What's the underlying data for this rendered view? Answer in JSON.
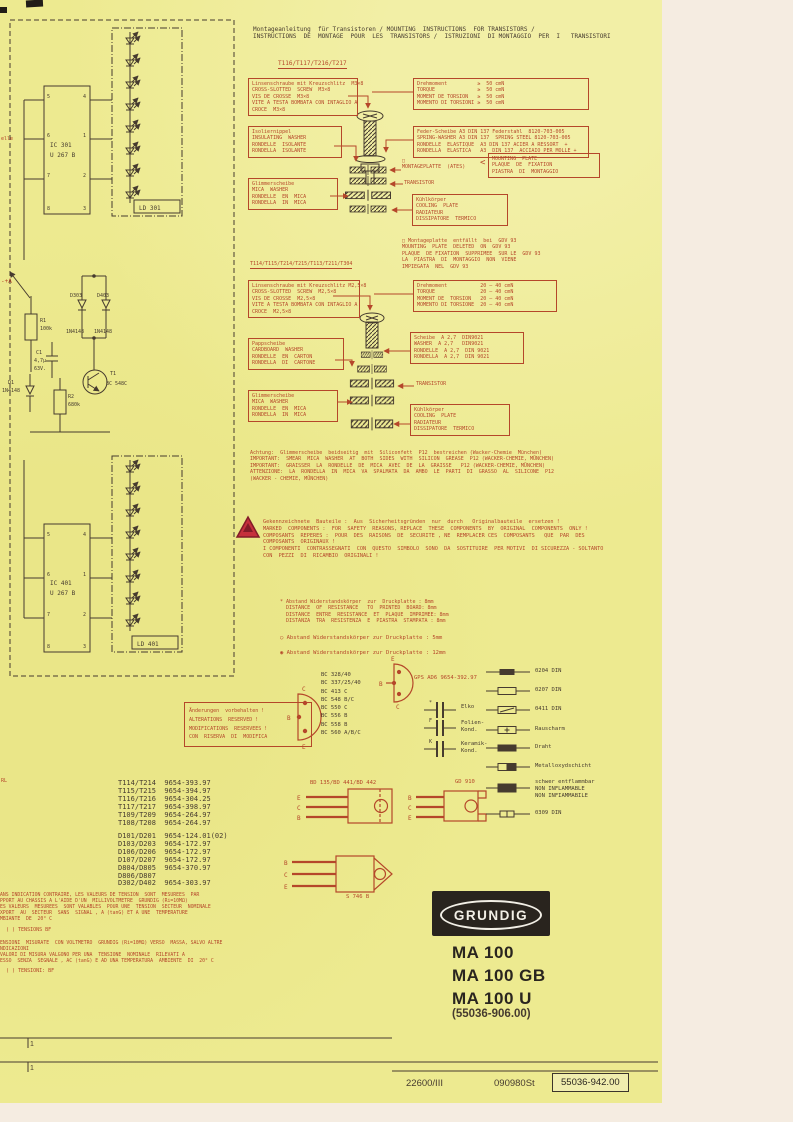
{
  "colors": {
    "accent": "#b5472a",
    "paper": "#edea90",
    "ink": "#463b2f"
  },
  "header": {
    "title": [
      "Montageanleitung  für Transistoren / MOUNTING  INSTRUCTIONS  FOR TRANSISTORS /",
      "INSTRUCTIONS  DE  MONTAGE  POUR  LES  TRANSISTORS /  ISTRUZIONI  DI MONTAGGIO  PER  I   TRANSISTORI"
    ]
  },
  "group1": {
    "heading": "T116/T117/T216/T217",
    "screw": [
      "Linsenschraube mit Kreuzschlitz  M3×8",
      "CROSS-SLOTTED  SCREW  M3×8",
      "VIS DE CROSSE  M3×8",
      "VITE A TESTA BOMBATA CON INTAGLIO A",
      "CROCE  M3×8"
    ],
    "torque": [
      "Drehmoment          ≥  50 cmN",
      "TORQUE              ≥  50 cmN",
      "MOMENT DE TORSION   ≥  50 cmN",
      "MOMENTO DI TORSIONI ≥  50 cmN"
    ],
    "spring": [
      "Feder-Scheibe A3 DIN 137 Federstahl  8120-703-005",
      "SPRING-WASHER A3 DIN 137  SPRING STEEL 8120-703-005",
      "RONDELLE  ELASTIQUE  A3 DIN 137 ACIER A RESSORT  +",
      "RONDELLA  ELASTICA   A3  DIN 137  ACCIAIO PER MOLLE +"
    ],
    "insulating": [
      "Isoliernippel",
      "INSULATING  WASHER",
      "RONDELLE  ISOLANTE",
      "RONDELLA  ISOLANTE"
    ],
    "mica": [
      "Glimmerscheibe",
      "MICA  WASHER",
      "RONDELLE  EN  MICA",
      "RONDELLA  IN  MICA"
    ],
    "plate_label": [
      "□",
      "MONTAGEPLATTE  (ATES)"
    ],
    "brace": "<",
    "plate_box": [
      "MOUNTING  PLATE",
      "PLAQUE  DE  FIXATION",
      "PIASTRA  DI  MONTAGGIO"
    ],
    "transistor_label": "TRANSISTOR",
    "cooling": [
      "Kühlkörper",
      "COOLING  PLATE",
      "RADIATEUR",
      "DISSIPATORE  TERMICO"
    ]
  },
  "gdv_note": [
    "□ Montageplatte  entfällt  bei  GDV 93",
    "MOUNTING  PLATE  DELETED  ON  GDV 93",
    "PLAQUE  DE FIXATION  SUPPRIMEE  SUR LE  GDV 93",
    "LA  PIASTRA  DI  MONTAGGIO  NON  VIENE",
    "IMPIEGATA  NEL  GDV 93"
  ],
  "group2": {
    "heading": "T114/T115/T214/T215/T113/T211/T304",
    "screw": [
      "Linsenschraube mit Kreuzschlitz M2,5×8",
      "CROSS-SLOTTED  SCREW  M2,5×8",
      "VIS DE CROSSE  M2,5×8",
      "VITE A TESTA BOMBATA CON INTAGLIO A",
      "CROCE  M2,5×8"
    ],
    "torque": [
      "Drehmoment           20 – 40 cmN",
      "TORQUE               20 – 40 cmN",
      "MOMENT DE  TORSION   20 – 40 cmN",
      "MOMENTO DI TORSIONE  20 – 40 cmN"
    ],
    "cardboard": [
      "Pappscheibe",
      "CARDBOARD  WASHER",
      "RONDELLE  EN  CARTON",
      "RONDELLA  DI  CARTONE"
    ],
    "washer": [
      "Scheibe  A 2,7  DIN9021",
      "WASHER  A 2,7   DIN9021",
      "RONDELLE  A 2,7  DIN 9021",
      "RONDELLA  A 2,7  DIN 9021"
    ],
    "transistor_label": "TRANSISTOR",
    "mica": [
      "Glimmerscheibe",
      "MICA  WASHER",
      "RONDELLE  EN  MICA",
      "RONDELLA  IN  MICA"
    ],
    "cooling": [
      "Kühlkörper",
      "COOLING  PLATE",
      "RADIATEUR",
      "DISSIPATORE  TERMICO"
    ]
  },
  "achtung": [
    "Achtung:  Glimmerscheibe  beidseitig  mit  Siliconfett  P12  bestreichen (Wacker-Chemie  München)",
    "IMPORTANT:  SMEAR  MICA  WASHER  AT  BOTH  SIDES  WITH  SILICON  GREASE  P12 (WACKER-CHEMIE, MÜNCHEN)",
    "IMPORTANT:  GRAISSER  LA  RONDELLE  DE  MICA  AVEC  DE  LA  GRAISSE   P12 (WACKER-CHEMIE, MÜNCHEN)",
    "ATTENZIONE:  LA  RONDELLA  IN  MICA  VA  SPALMATA  DA  AMBO  LE  PARTI  DI  GRASSO  AL  SILICONE  P12",
    "(WACKER - CHEMIE, MÜNCHEN)"
  ],
  "safety": [
    "Gekennzeichnete  Bauteile :  Aus  Sicherheitsgründen  nur  durch   Originalbauteile  ersetzen !",
    "MARKED  COMPONENTS :  FOR  SAFETY  REASONS, REPLACE  THESE  COMPONENTS  BY  ORIGINAL  COMPONENTS  ONLY !",
    "COMPOSANTS  REPERES :  POUR  DES  RAISONS  DE  SECURITE , NE  REMPLACER CES  COMPOSANTS   QUE  PAR  DES",
    "COMPOSANTS  ORIGINAUX !",
    "I COMPONENTI  CONTRASSEGNATI  CON  QUESTO  SIMBOLO  SONO  DA  SOSTITUIRE  PER MOTIVI  DI SICUREZZA - SOLTANTO",
    "CON  PEZZI  DI  RICAMBIO  ORIGINALI !"
  ],
  "distance": {
    "star": [
      "* Abstand Widerstandskörper  zur  Druckplatte : 8mm",
      "  DISTANCE  OF  RESISTANCE   TO  PRINTED  BOARD: 8mm",
      "  DISTANCE  ENTRE  RESISTANCE  ET  PLAQUE  IMPRIMEE: 8mm",
      "  DISTANZA  TRA  RESISTENZA  E  PIASTRA  STAMPATA : 8mm"
    ],
    "circle": "○ Abstand  Widerstandskörper  zur  Druckplatte : 5mm",
    "target": "◉ Abstand  Widerstandskörper  zur  Druckplatte : 12mm"
  },
  "semis": {
    "bc": [
      "BC 328/40",
      "BC 337/25/40",
      "BC 413 C",
      "BC 548 B/C",
      "BC 550 C",
      "BC 556 B",
      "BC 558 B",
      "BC 560 A/B/C"
    ],
    "gps": "GPS AD6  9654-392.97",
    "bd": "BD 135/BD 441/BD 442",
    "gd": "GD 910",
    "pkg3": "S 746 B",
    "to92_pins": [
      "C",
      "B",
      "E"
    ],
    "gps_pins": [
      "E",
      "B",
      "C"
    ],
    "bd_pins": [
      "E",
      "C",
      "B"
    ],
    "gd_pins": [
      "B",
      "C",
      "E"
    ],
    "pkg3_pins": [
      "B",
      "C",
      "E"
    ]
  },
  "cap": {
    "m_elko": "*",
    "elko": "Elko",
    "m_f": "F",
    "folien": [
      "Folien-",
      "Kond."
    ],
    "m_k": "K",
    "keramik": [
      "Keramik-",
      "Kond."
    ]
  },
  "res": {
    "r1": "0204 DIN",
    "r2": "0207 DIN",
    "r3": "0411 DIN",
    "r4": "Rauscharm",
    "r5": "Draht",
    "r6": "Metalloxydschicht",
    "r7": [
      "schwer entflammbar",
      "NON INFLAMMABLE",
      "NON INFIAMMABILE"
    ],
    "r8": "0309 DIN"
  },
  "changes": [
    "Änderungen  vorbehalten !",
    "ALTERATIONS  RESERVED !",
    "MODIFICATIONS  RESERVEES !",
    "CON  RISERVA  DI  MODIFICA"
  ],
  "parts": {
    "t": [
      "T114/T214  9654-393.97",
      "T115/T215  9654-394.97",
      "T116/T216  9654-304.25",
      "T117/T217  9654-398.97",
      "T109/T209  9654-264.97",
      "T108/T208  9654-264.97"
    ],
    "d": [
      "D101/D201  9654-124.01(02)",
      "D103/D203  9654-172.97",
      "D106/D206  9654-172.97",
      "D107/D207  9654-172.97",
      "D804/D805  9654-370.97",
      "D806/D807",
      "D302/D402  9654-303.97"
    ]
  },
  "notes": {
    "fr": [
      "ANS INDICATION CONTRAIRE, LES VALEURS DE TENSION  SONT  MESUREES  PAR",
      "PPORT AU CHASSIS A L'AIDE D'UN  MILLIVOLTMETRE  GRUNDIG (Ri=10MΩ)",
      "ES VALEURS  MESUREES  SONT VALABLES  POUR UNE  TENSION  SECTEUR  NOMINALE",
      "XPORT  AU  SECTEUR  SANS  SIGNAL , A (tanG) ET A UNE  TEMPERATURE",
      "MBIANTE  DE  20° C"
    ],
    "fr_bf": "(      )  TENSIONS  BF",
    "it": [
      "ENSIONI  MISURATE  CON VOLTMETRO  GRUNDIG (Ri=10MΩ) VERSO  MASSA, SALVO ALTRE",
      "NDICAZIONI",
      "VALORI DI MISURA VALGONO PER UNA  TENSIONE  NOMINALE  RILEVATI A",
      "ESSO  SENZA  SEGNALE , AC (tanG) E AD UNA TEMPERATURA  AMBIENTE  DI  20° C"
    ],
    "it_bf": "(      )  TENSIONI:  BF"
  },
  "brand": {
    "logo": "GRUNDIG",
    "models": [
      "MA 100",
      "MA 100 GB",
      "MA 100 U"
    ],
    "part": "(55036-906.00)"
  },
  "footer": {
    "n1": "1",
    "n2": "1",
    "print": "22600/III",
    "code": "090980St",
    "doc": "55036-942.00"
  },
  "sch": {
    "ic1": "IC 301",
    "u1": "U 267 B",
    "ld1": "LD 301",
    "ic2": "IC 401",
    "u2": "U 267 B",
    "ld2": "LD 401",
    "d303": "D303",
    "d403": "D403",
    "dn1": "1N4148",
    "dn2": "1N4148",
    "r1": "R1",
    "r1v": "100k",
    "c1": "C1",
    "c1v": "4,7µ",
    "c1u": "63V.",
    "t1": "T1",
    "t1v": "BC 548C",
    "d1": "D1",
    "d1v": "1N4148",
    "r2": "R2",
    "r2v": "680k",
    "pa": "-+A",
    "elle": "elle",
    "rl": "RL",
    "pinsL": [
      "5",
      "6",
      "7",
      "8"
    ],
    "pinsR": [
      "4",
      "1",
      "2",
      "3"
    ]
  }
}
